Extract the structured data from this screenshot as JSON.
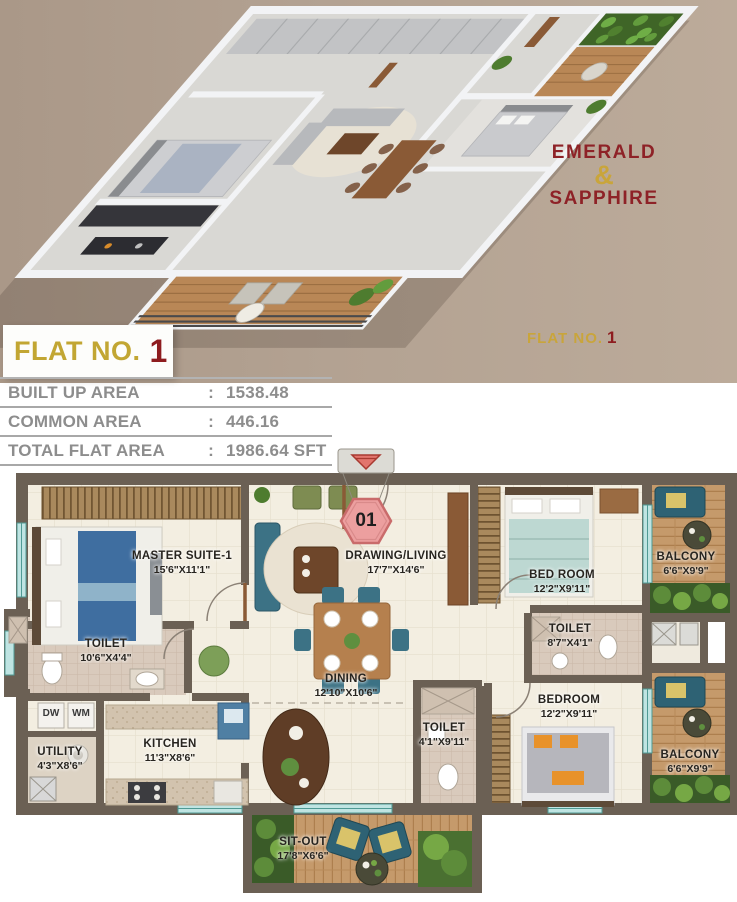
{
  "top": {
    "brand_line1": "EMERALD",
    "brand_amp": "&",
    "brand_line2": "SAPPHIRE",
    "flat_no_right": {
      "prefix": "FLAT NO.",
      "number": "1"
    },
    "colors": {
      "background": "#b3a292",
      "brand_red": "#8e2227",
      "brand_gold": "#c9a53b"
    }
  },
  "flat_banner": {
    "prefix": "FLAT NO.",
    "number": "1"
  },
  "area_table": {
    "rows": [
      {
        "label": "BUILT UP AREA",
        "colon": ":",
        "value": "1538.48"
      },
      {
        "label": "COMMON AREA",
        "colon": ":",
        "value": "446.16"
      },
      {
        "label": "TOTAL FLAT AREA",
        "colon": ":",
        "value": "1986.64 SFT"
      }
    ]
  },
  "floor_plan": {
    "unit_badge": "01",
    "rooms": [
      {
        "name": "MASTER SUITE-1",
        "dims": "15'6\"X11'1\""
      },
      {
        "name": "DRAWING/LIVING",
        "dims": "17'7\"X14'6\""
      },
      {
        "name": "BED ROOM",
        "dims": "12'2\"X9'11\""
      },
      {
        "name": "BALCONY",
        "dims": "6'6\"X9'9\""
      },
      {
        "name": "TOILET",
        "dims": "10'6\"X4'4\""
      },
      {
        "name": "TOILET",
        "dims": "8'7\"X4'1\""
      },
      {
        "name": "UTILITY",
        "dims": "4'3\"X8'6\""
      },
      {
        "name": "KITCHEN",
        "dims": "11'3\"X8'6\""
      },
      {
        "name": "DINING",
        "dims": "12'10\"X10'6\""
      },
      {
        "name": "TOILET",
        "dims": "4'1\"X9'11\""
      },
      {
        "name": "BEDROOM",
        "dims": "12'2\"X9'11\""
      },
      {
        "name": "BALCONY",
        "dims": "6'6\"X9'9\""
      },
      {
        "name": "SIT-OUT",
        "dims": "17'8\"X6'6\""
      }
    ],
    "appliances": {
      "dw": "DW",
      "wm": "WM"
    }
  }
}
